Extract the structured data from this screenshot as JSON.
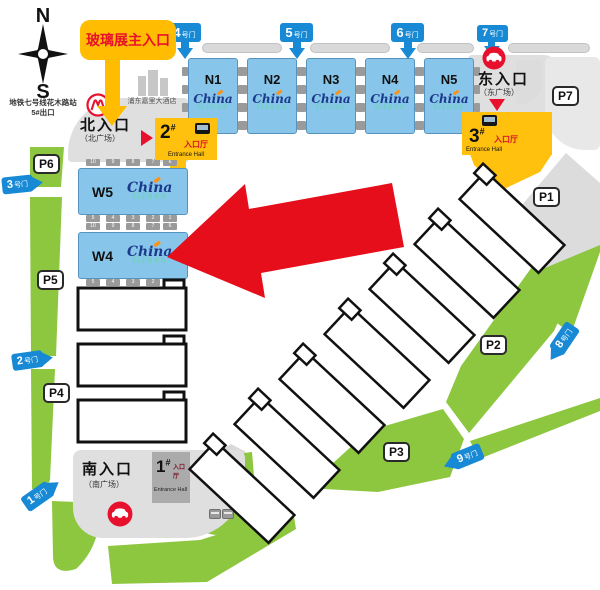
{
  "compass": {
    "n": "N",
    "s": "S",
    "station": "地铁七号线花木路站",
    "exit": "5#出口"
  },
  "callout": {
    "text": "玻璃展主入口"
  },
  "hotel": {
    "name": "浦东嘉里大酒店"
  },
  "gates": {
    "g1": {
      "num": "1",
      "suffix": "号门"
    },
    "g2": {
      "num": "2",
      "suffix": "号门"
    },
    "g3": {
      "num": "3",
      "suffix": "号门"
    },
    "g4": {
      "num": "4",
      "suffix": "号门"
    },
    "g5": {
      "num": "5",
      "suffix": "号门"
    },
    "g6": {
      "num": "6",
      "suffix": "号门"
    },
    "g7": {
      "num": "7",
      "suffix": "号门"
    },
    "g8": {
      "num": "8",
      "suffix": "号门"
    },
    "g9": {
      "num": "9",
      "suffix": "号门"
    }
  },
  "halls": {
    "n1": "N1",
    "n2": "N2",
    "n3": "N3",
    "n4": "N4",
    "n5": "N5",
    "w5": "W5",
    "w4": "W4"
  },
  "logo": {
    "line1": "China",
    "line2": "Glass"
  },
  "entrances": {
    "north": {
      "title": "北入口",
      "subtitle": "（北广场）"
    },
    "east": {
      "title": "东入口",
      "subtitle": "（东广场）"
    },
    "south": {
      "title": "南入口",
      "subtitle": "（南广场）"
    }
  },
  "entrance_halls": {
    "h1": {
      "num": "1",
      "hash": "#",
      "label": "入口厅",
      "en": "Entrance Hall"
    },
    "h2": {
      "num": "2",
      "hash": "#",
      "label": "入口厅",
      "en": "Entrance Hall"
    },
    "h3": {
      "num": "3",
      "hash": "#",
      "label": "入口厅",
      "en": "Entrance Hall"
    }
  },
  "parking": {
    "p1": "P1",
    "p2": "P2",
    "p3": "P3",
    "p4": "P4",
    "p5": "P5",
    "p6": "P6",
    "p7": "P7"
  },
  "tabs": {
    "w_top": [
      "10",
      "9",
      "8",
      "7",
      "6"
    ],
    "w_bottom": [
      "5",
      "4",
      "3",
      "2",
      "1"
    ]
  }
}
